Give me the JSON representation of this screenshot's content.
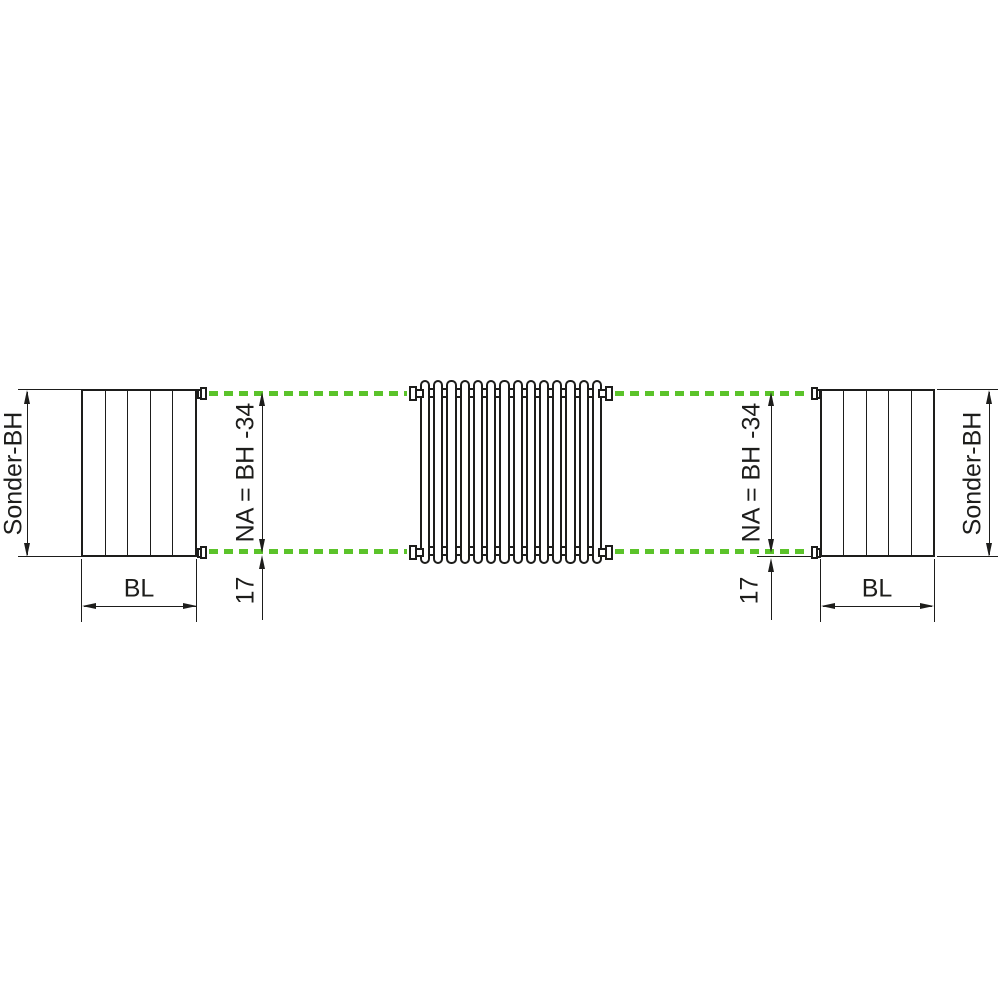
{
  "colors": {
    "line_color": "#1d1d1b",
    "accent_green": "#5bc32a",
    "background": "#ffffff"
  },
  "labels": {
    "sonder_bh": "Sonder-BH",
    "bl": "BL",
    "na_formula": "NA = BH -34",
    "axis_offset": "17"
  },
  "side_view": {
    "panel_count": 5
  },
  "radiator": {
    "column_count": 14
  }
}
